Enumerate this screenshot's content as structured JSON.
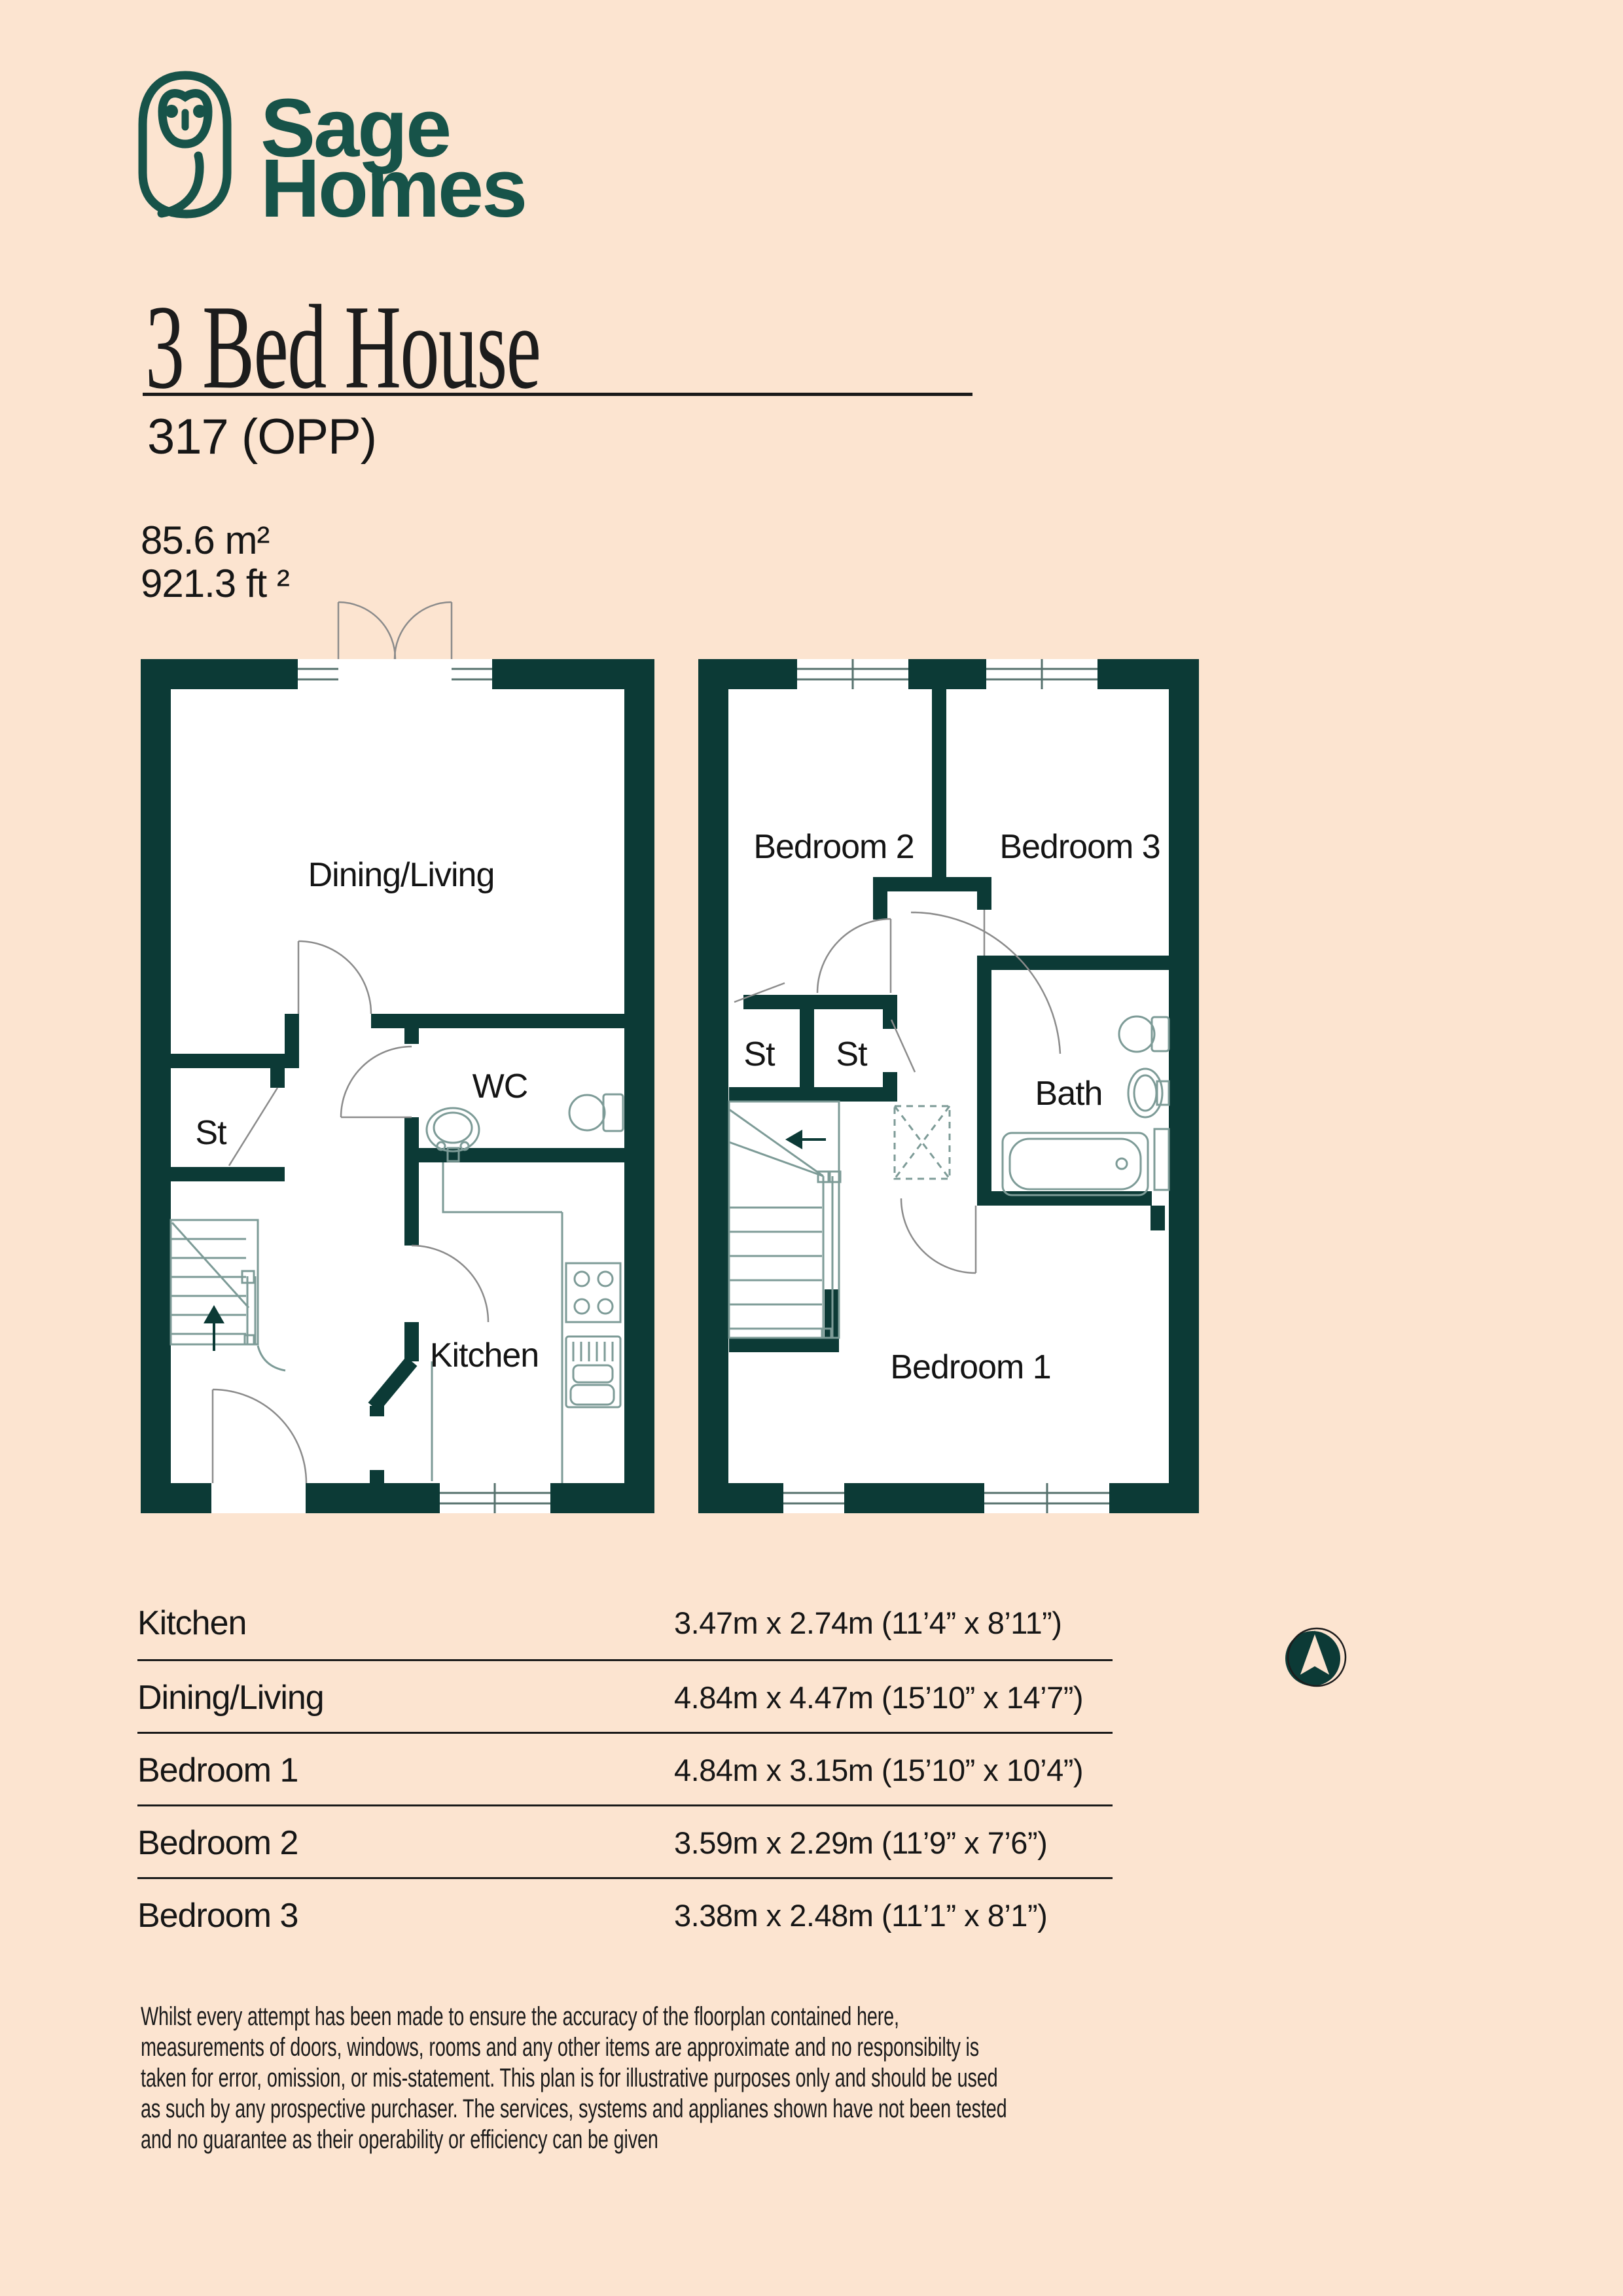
{
  "brand": {
    "line1": "Sage",
    "line2": "Homes"
  },
  "page": {
    "title": "3 Bed House",
    "plot": "317 (OPP)",
    "area_metric": "85.6 m²",
    "area_imperial": "921.3 ft ²"
  },
  "plans": {
    "ground": {
      "dining_living": "Dining/Living",
      "st": "St",
      "wc": "WC",
      "kitchen": "Kitchen"
    },
    "first": {
      "bedroom2": "Bedroom 2",
      "bedroom3": "Bedroom 3",
      "st1": "St",
      "st2": "St",
      "bath": "Bath",
      "bedroom1": "Bedroom 1"
    }
  },
  "dimensions": {
    "rows": [
      {
        "room": "Kitchen",
        "size": "3.47m x 2.74m (11’4” x 8’11”)"
      },
      {
        "room": "Dining/Living",
        "size": "4.84m x 4.47m (15’10” x 14’7”)"
      },
      {
        "room": "Bedroom 1",
        "size": "4.84m x 3.15m (15’10” x 10’4”)"
      },
      {
        "room": "Bedroom 2",
        "size": "3.59m x 2.29m (11’9” x 7’6”)"
      },
      {
        "room": "Bedroom 3",
        "size": "3.38m x 2.48m (11’1” x 8’1”)"
      }
    ]
  },
  "icons": {
    "logo": "owl-logo",
    "compass": "north-arrow"
  },
  "colors": {
    "background": "#fce4d0",
    "wall": "#0c3a36",
    "logo": "#175349",
    "thin_line": "#7d9b97",
    "door_line": "#8b8b8b"
  },
  "disclaimer": "Whilst every attempt has been made to ensure the accuracy of the floorplan contained here,\nmeasurements of doors, windows, rooms and any other items are approximate and no responsibilty is\ntaken for error, omission, or mis-statement. This plan is for illustrative purposes only and should be used\nas such by any prospective purchaser. The services, systems and applianes shown have not been tested\nand no guarantee as their operability or efficiency can be given"
}
